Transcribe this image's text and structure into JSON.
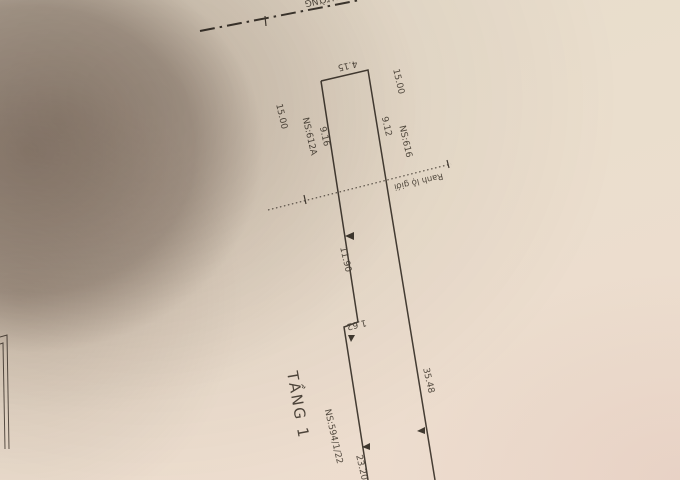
{
  "plan": {
    "floor_label": "TẦNG 1",
    "road_boundary_label": "Ranh lộ giới",
    "street_name_partial": "ĐƯỜNG",
    "parcel_number": "NS:594/1/22",
    "left_neighbor": "NS:612A",
    "right_neighbor": "NS:616",
    "dimensions": {
      "front_width": "4.15",
      "left_setback": "15.00",
      "right_setback": "15.00",
      "left_front_depth": "9.16",
      "right_front_depth": "9.12",
      "left_middle_depth": "11.90",
      "side_step": "1.62",
      "right_total_depth": "35.48",
      "left_rear_depth": "23.20"
    }
  },
  "colors": {
    "paper": "#eadecd",
    "shadow": "#9b8d85",
    "ink": "#443c33"
  }
}
